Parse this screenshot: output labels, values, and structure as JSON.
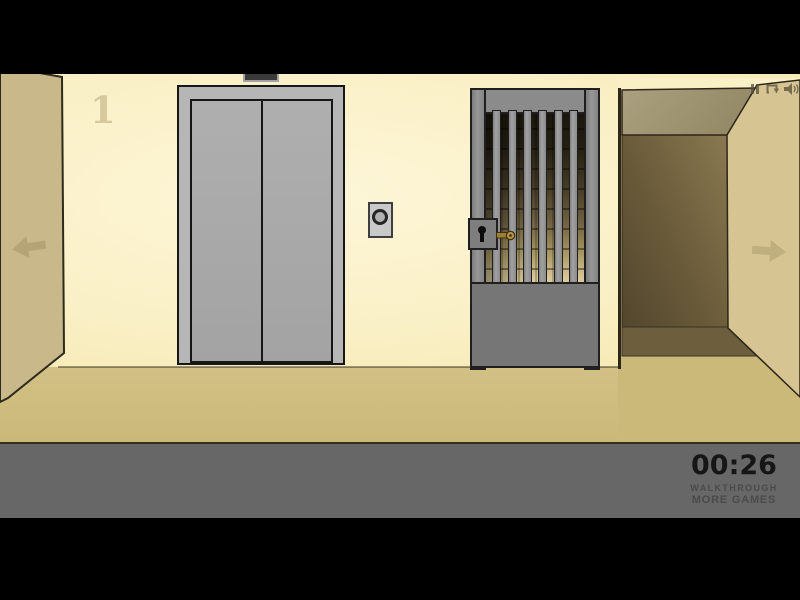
{
  "hud": {
    "floor_number": "1",
    "timer": "00:26",
    "walkthrough_label": "WALKTHROUGH",
    "more_games_label": "MORE GAMES"
  },
  "icons": {
    "top_right": [
      "pause-icon",
      "replay-icon",
      "sound-icon"
    ],
    "navigation": [
      "arrow-left-icon",
      "arrow-right-icon"
    ],
    "scene": [
      "keyhole-icon",
      "key-icon"
    ]
  },
  "colors": {
    "letterbox": "#000000",
    "wall": "#faf0c6",
    "wall-light": "#fdf6d8",
    "side-wall": "#c8b88a",
    "floor": "#cbb97a",
    "corr-ceiling": "#a2977a",
    "corr-dark": "#584a2f",
    "corr-wall": "#d6c593",
    "corr-floor": "#6d5e3d",
    "elev-frame": "#b6b6b6",
    "elev-door": "#a3a3a3",
    "gate-gray": "#8b8b8b",
    "gate-bottom": "#767676",
    "key-brass": "#b39245",
    "hud-band": "#676767",
    "timer-text": "#161616",
    "link-text": "#4a4a4a",
    "arrow": "#b4a476",
    "outline": "#2c2718"
  }
}
